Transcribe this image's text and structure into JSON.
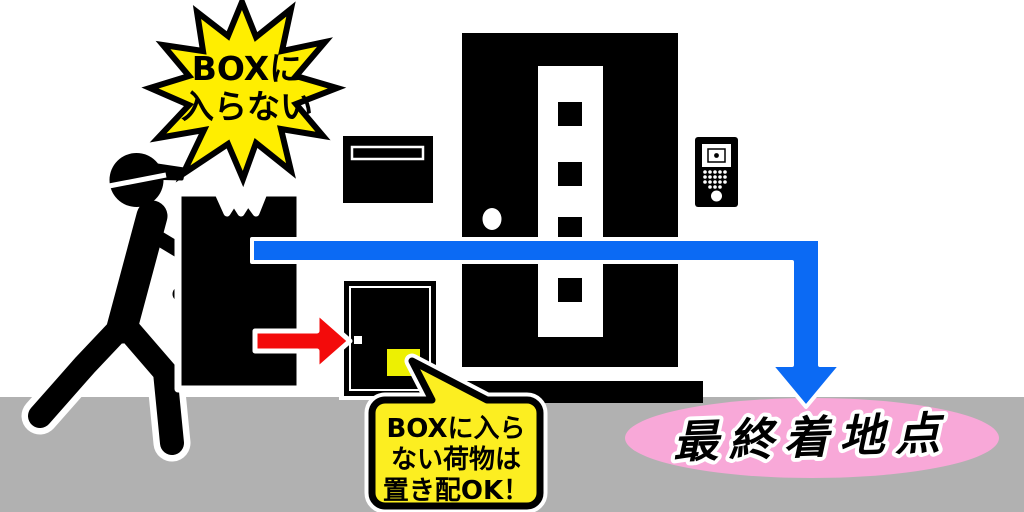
{
  "starburst": {
    "line1": "BOXに",
    "line2": "入らない"
  },
  "speech_bubble": {
    "line1": "BOXに入ら",
    "line2": "ない荷物は",
    "line3": "置き配OK！"
  },
  "destination": {
    "label": "最終着地点"
  },
  "colors": {
    "background": "#ffffff",
    "floor_gray": "#b1b1b1",
    "silhouette_black": "#000000",
    "starburst_yellow": "#ffee00",
    "bubble_yellow": "#fcee21",
    "package_yellow": "#edf002",
    "arrow_red": "#f30b0b",
    "arrow_blue": "#0b6af4",
    "destination_pink": "#f8a8d8"
  }
}
